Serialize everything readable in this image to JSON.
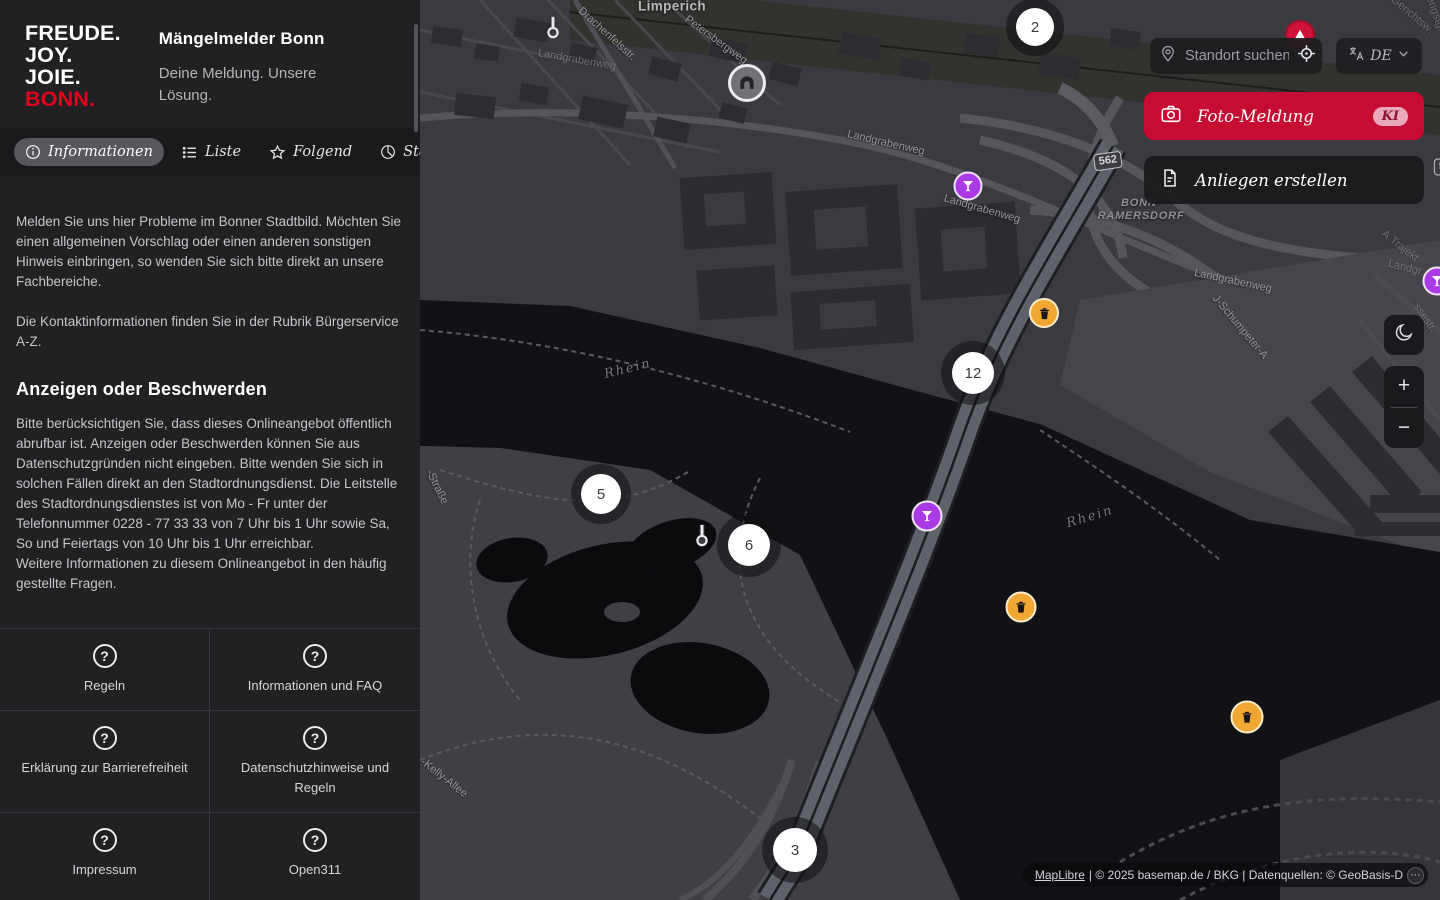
{
  "colors": {
    "brand_red": "#e2001a",
    "accent_red": "#c60c33",
    "marker_amber": "#f2a735",
    "marker_purple": "#a93ae6",
    "marker_red": "#cf1237"
  },
  "sidebar": {
    "logo_lines": [
      "FREUDE.",
      "JOY.",
      "JOIE.",
      "BONN."
    ],
    "title": "Mängelmelder Bonn",
    "subtitle": "Deine Meldung. Unsere Lösung.",
    "tabs": [
      {
        "label": "Informationen",
        "icon": "info-icon",
        "active": true
      },
      {
        "label": "Liste",
        "icon": "list-icon",
        "active": false
      },
      {
        "label": "Folgend",
        "icon": "star-icon",
        "active": false
      },
      {
        "label": "Statistik",
        "icon": "chart-pie-icon",
        "active": false
      }
    ],
    "paragraphs": [
      "Melden Sie uns hier Probleme im Bonner Stadtbild. Möchten Sie einen allgemeinen Vorschlag oder einen anderen sonstigen Hinweis einbringen, so wenden Sie sich bitte direkt an unsere Fachbereiche.",
      "Die Kontaktinformationen finden Sie in der Rubrik Bürgerservice A-Z."
    ],
    "heading": "Anzeigen oder Beschwerden",
    "paragraph_after": "Bitte berücksichtigen Sie, dass dieses Onlineangebot öffentlich abrufbar ist. Anzeigen oder Beschwerden können Sie aus Datenschutzgründen nicht eingeben. Bitte wenden Sie sich in solchen Fällen direkt an den Stadtordnungsdienst. Die Leitstelle des Stadtordnungsdienstes ist von Mo - Fr unter der Telefonnummer 0228 - 77 33 33 von 7 Uhr bis 1 Uhr sowie Sa, So und Feiertags von 10 Uhr bis 1 Uhr erreichbar.\nWeitere Informationen zu diesem Onlineangebot in den häufig gestellte Fragen.",
    "footer_links": [
      {
        "label": "Regeln",
        "icon": "help-icon"
      },
      {
        "label": "Informationen und FAQ",
        "icon": "help-icon"
      },
      {
        "label": "Erklärung zur Barrierefreiheit",
        "icon": "help-icon"
      },
      {
        "label": "Datenschutzhinweise und Regeln",
        "icon": "help-icon"
      },
      {
        "label": "Impressum",
        "icon": "help-icon"
      },
      {
        "label": "Open311",
        "icon": "help-icon"
      }
    ]
  },
  "map": {
    "search": {
      "placeholder": "Standort suchen",
      "left_icon": "location-pin-icon",
      "right_icon": "crosshair-icon"
    },
    "language": {
      "code": "DE",
      "icon": "translate-icon",
      "chevron": "chevron-down-icon"
    },
    "foto_button": {
      "label": "Foto-Meldung",
      "badge": "KI",
      "icon": "camera-icon"
    },
    "anliegen_button": {
      "label": "Anliegen erstellen",
      "icon": "document-icon"
    },
    "controls": {
      "dark_mode_icon": "moon-icon",
      "zoom_in": "+",
      "zoom_out": "−"
    },
    "attribution": {
      "link": "MapLibre",
      "text": " | © 2025 basemap.de / BKG | Datenquellen: © GeoBasis-D",
      "toggle_icon": "attribution-toggle-icon"
    },
    "labels": [
      {
        "text": "Limperich",
        "x": 672,
        "y": 6,
        "r": 0,
        "cls": "town"
      },
      {
        "text": "Drachenfelsstr.",
        "x": 607,
        "y": 34,
        "r": 42,
        "cls": ""
      },
      {
        "text": "Landgrabenweg",
        "x": 577,
        "y": 60,
        "r": 10,
        "cls": "faint"
      },
      {
        "text": "Petersbergweg",
        "x": 716,
        "y": 40,
        "r": 36,
        "cls": ""
      },
      {
        "text": "Landgrabenweg",
        "x": 886,
        "y": 143,
        "r": 13,
        "cls": ""
      },
      {
        "text": "Landgrabenweg",
        "x": 982,
        "y": 209,
        "r": 16,
        "cls": ""
      },
      {
        "text": "BONN-\nRAMERSDORF",
        "x": 1141,
        "y": 210,
        "r": 0,
        "cls": "district"
      },
      {
        "text": "Landgrabenweg",
        "x": 1233,
        "y": 281,
        "r": 12,
        "cls": ""
      },
      {
        "text": "J-Schumpeter-A",
        "x": 1240,
        "y": 327,
        "r": 50,
        "cls": ""
      },
      {
        "text": "A.Trajekt",
        "x": 1400,
        "y": 246,
        "r": 38,
        "cls": "faint"
      },
      {
        "text": "Landgr.",
        "x": 1406,
        "y": 268,
        "r": 14,
        "cls": "faint"
      },
      {
        "text": "ssestr.",
        "x": 1425,
        "y": 318,
        "r": 55,
        "cls": "faint"
      },
      {
        "text": "Rhein",
        "x": 628,
        "y": 369,
        "r": -14,
        "cls": "water"
      },
      {
        "text": "Rhein",
        "x": 1090,
        "y": 517,
        "r": -17,
        "cls": "water"
      },
      {
        "text": "-Straße",
        "x": 437,
        "y": 487,
        "r": 64,
        "cls": ""
      },
      {
        "text": "-Kelly-Allee",
        "x": 444,
        "y": 778,
        "r": 38,
        "cls": ""
      },
      {
        "text": "Gerichtsw.",
        "x": 1412,
        "y": 15,
        "r": 40,
        "cls": "faint"
      },
      {
        "text": "Hengstg.",
        "x": 1434,
        "y": 10,
        "r": 70,
        "cls": "faint"
      }
    ],
    "shields": [
      {
        "text": "562",
        "x": 1108,
        "y": 161,
        "r": -8
      },
      {
        "text": "562",
        "x": 1448,
        "y": 167,
        "r": 0
      }
    ],
    "markers": [
      {
        "type": "poi",
        "icon": "thermometer-icon",
        "x": 553,
        "y": 27
      },
      {
        "type": "cluster",
        "label": "2",
        "x": 1035,
        "y": 27,
        "d": 38
      },
      {
        "type": "poi-circle",
        "icon": "tunnel-icon",
        "x": 747,
        "y": 83,
        "d": 38
      },
      {
        "type": "pin-red",
        "icon": "alert-icon",
        "x": 1300,
        "y": 35,
        "d": 30
      },
      {
        "type": "pin-purple",
        "icon": "cocktail-icon",
        "x": 968,
        "y": 186,
        "d": 29
      },
      {
        "type": "pin-trash",
        "icon": "trash-icon",
        "x": 1044,
        "y": 313,
        "d": 30
      },
      {
        "type": "cluster",
        "label": "12",
        "x": 973,
        "y": 373,
        "d": 42
      },
      {
        "type": "cluster",
        "label": "5",
        "x": 601,
        "y": 494,
        "d": 40
      },
      {
        "type": "pin-purple",
        "icon": "cocktail-icon",
        "x": 927,
        "y": 516,
        "d": 31
      },
      {
        "type": "poi",
        "icon": "thermometer-icon",
        "x": 702,
        "y": 535
      },
      {
        "type": "cluster",
        "label": "6",
        "x": 749,
        "y": 545,
        "d": 42
      },
      {
        "type": "pin-trash",
        "icon": "trash-icon",
        "x": 1021,
        "y": 607,
        "d": 31
      },
      {
        "type": "pin-trash",
        "icon": "trash-icon",
        "x": 1247,
        "y": 717,
        "d": 33
      },
      {
        "type": "cluster",
        "label": "3",
        "x": 795,
        "y": 850,
        "d": 44
      },
      {
        "type": "pin-purple",
        "icon": "cocktail-icon",
        "x": 1437,
        "y": 281,
        "d": 29
      }
    ]
  }
}
